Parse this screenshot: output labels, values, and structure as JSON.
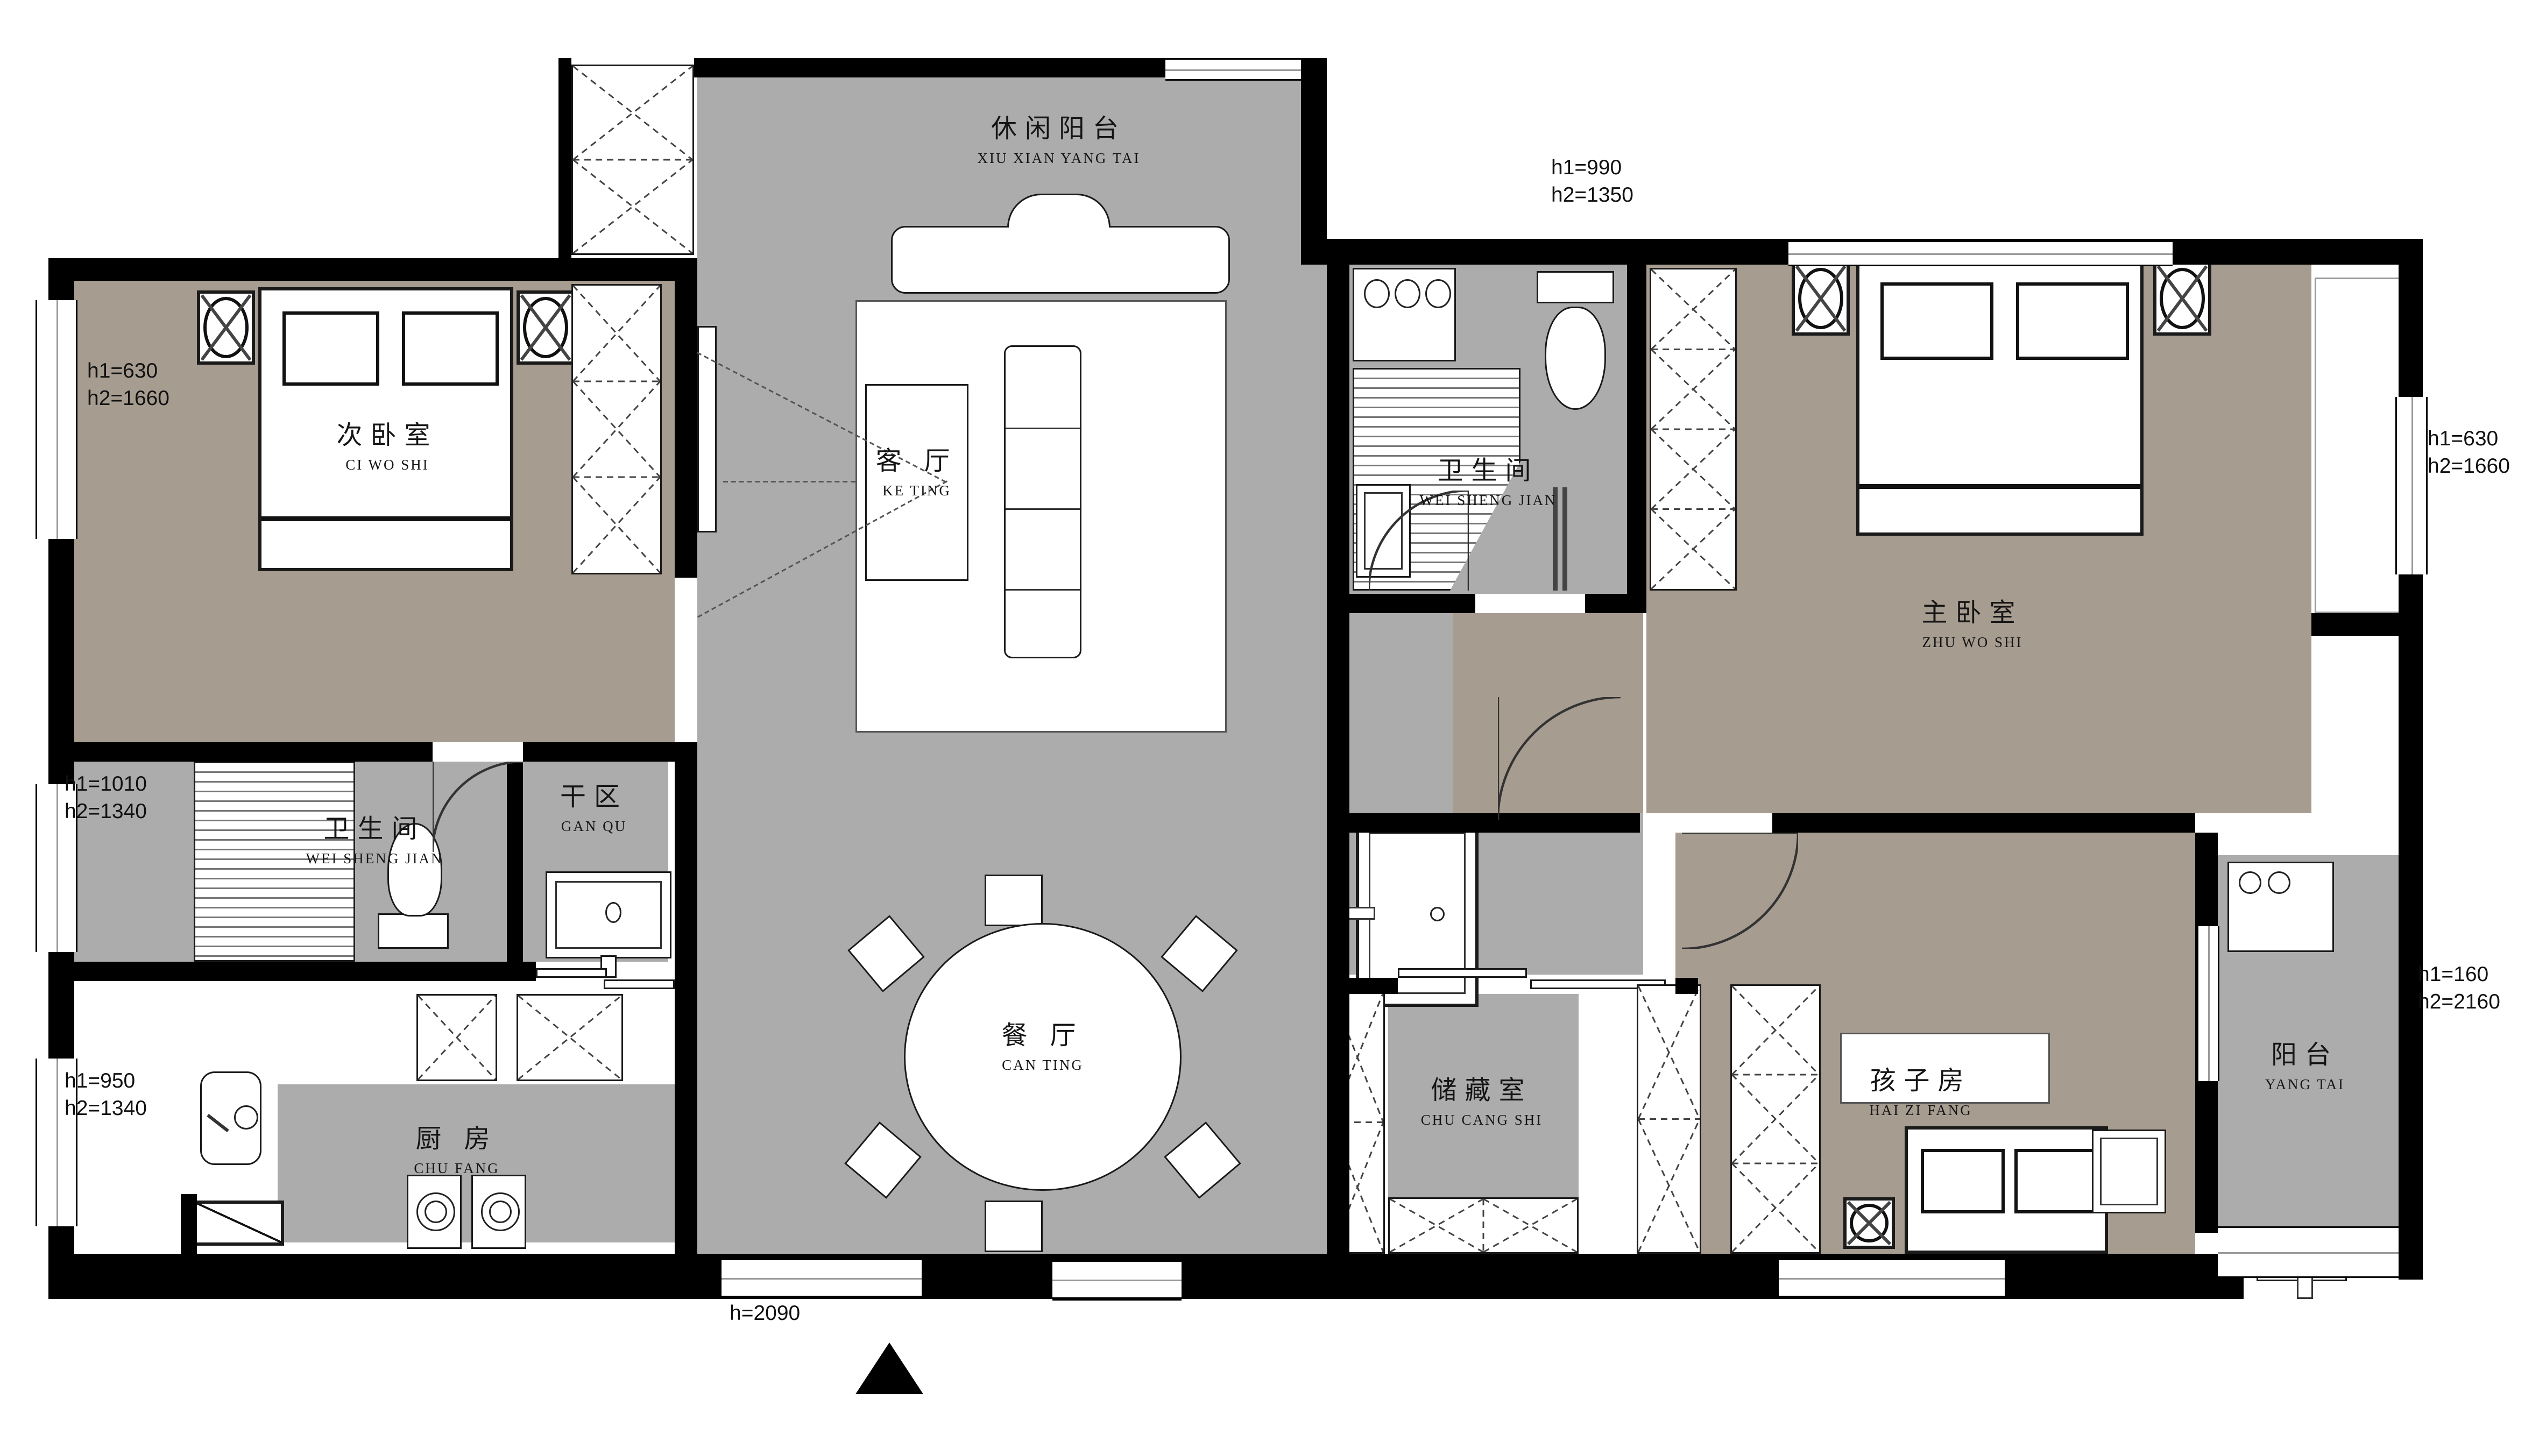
{
  "title": "三室两厅户型图 (apartment floor plan)",
  "colors": {
    "floor_gray": "#ACACAC",
    "floor_taupe": "#A79C90",
    "wall_black": "#000000",
    "line_dark": "#1a1a1a"
  },
  "rooms": {
    "leisure_balcony": {
      "zh": "休闲阳台",
      "en": "XIU XIAN YANG TAI"
    },
    "second_bedroom": {
      "zh": "次卧室",
      "en": "CI WO SHI"
    },
    "living_room": {
      "zh": "客 厅",
      "en": "KE TING"
    },
    "bathroom_master": {
      "zh": "卫生间",
      "en": "WEI SHENG JIAN"
    },
    "master_bedroom": {
      "zh": "主卧室",
      "en": "ZHU WO SHI"
    },
    "dry_area": {
      "zh": "干区",
      "en": "GAN QU"
    },
    "bathroom_left": {
      "zh": "卫生间",
      "en": "WEI SHENG JIAN"
    },
    "dining_room": {
      "zh": "餐 厅",
      "en": "CAN TING"
    },
    "kitchen": {
      "zh": "厨 房",
      "en": "CHU FANG"
    },
    "storage": {
      "zh": "储藏室",
      "en": "CHU CANG SHI"
    },
    "kids_room": {
      "zh": "孩子房",
      "en": "HAI ZI FANG"
    },
    "balcony": {
      "zh": "阳台",
      "en": "YANG TAI"
    }
  },
  "measurements": {
    "left_top": "h1=630\nh2=1660",
    "left_mid": "h1=1010\nh2=1340",
    "left_bottom": "h1=950\nh2=1340",
    "top_right": "h1=990\nh2=1350",
    "right_top": "h1=630\nh2=1660",
    "right_bottom": "h1=160\nh2=2160",
    "bottom_door": "h=2090"
  }
}
